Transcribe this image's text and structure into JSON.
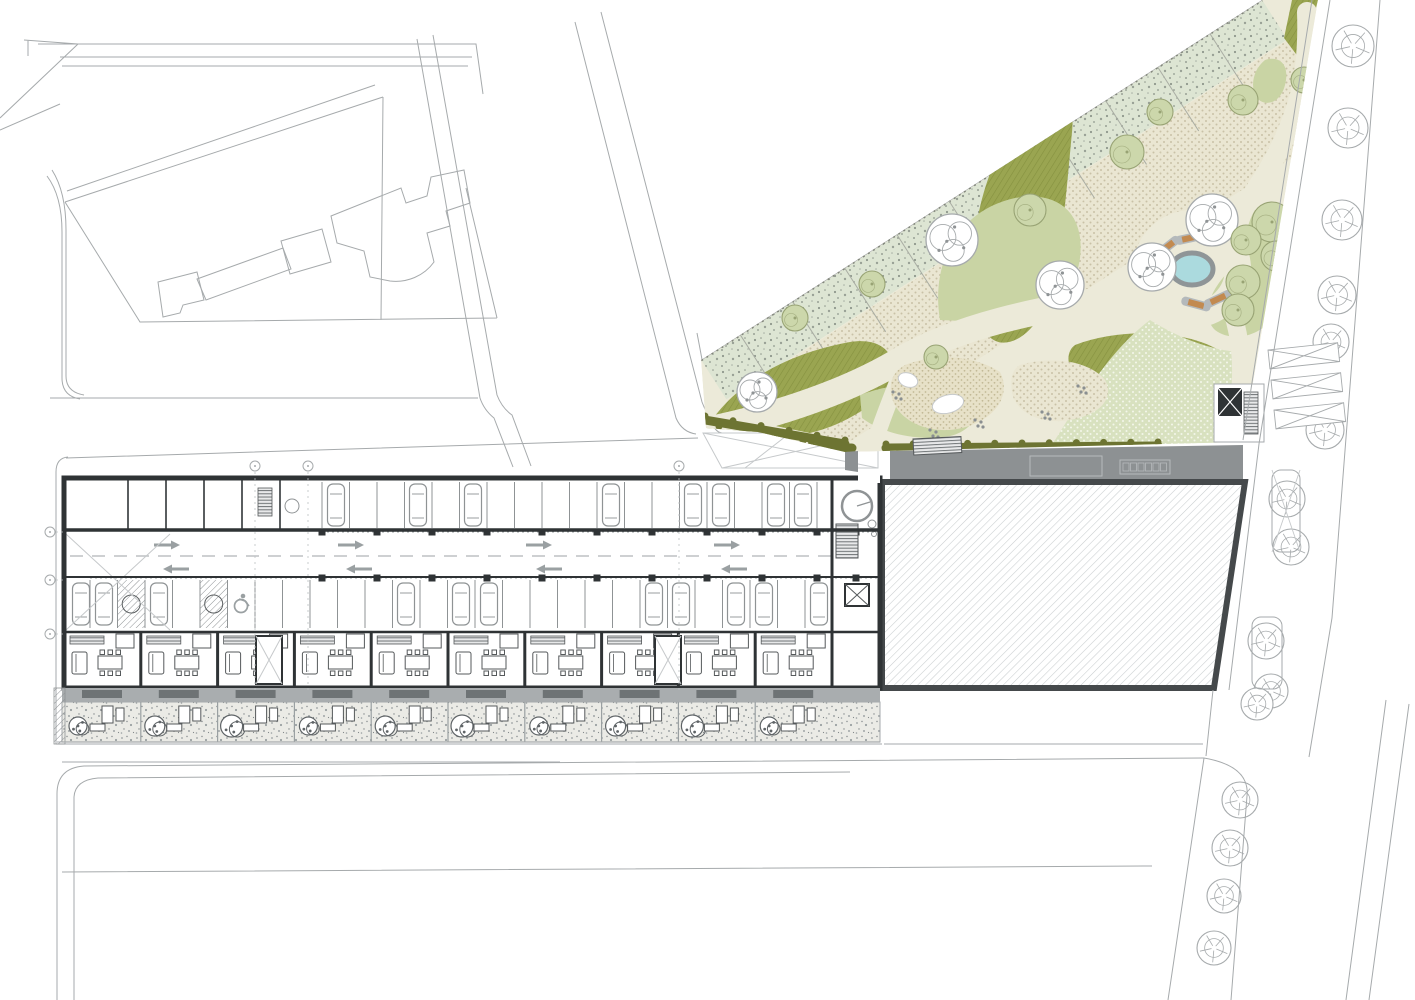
{
  "document": {
    "kind": "architectural-site-plan",
    "level": "ground-floor-plan"
  },
  "palette": {
    "line": "#a6aaac",
    "lineSoft": "#c6c9cb",
    "wall": "#2f3335",
    "wallMid": "#5a5e60",
    "roofGray": "#8d9193",
    "terraceGray": "#a9adaf",
    "matGray": "#6e7375",
    "cream": "#ecead9",
    "creamDot": "#c9c2a6",
    "sage": "#dde5d3",
    "olive": "#9aa551",
    "oliveLine": "#85913f",
    "greenLight": "#c9d4a4",
    "greenDotted": "#d8e1bf",
    "sand": "#e7e1c8",
    "pond": "#abdade",
    "pondRim": "#8f9597",
    "hedge": "#6d7432",
    "orange": "#c28a50",
    "treeGreen": "#ccd7ab",
    "treeGreenEdge": "#98a374",
    "gravel": "#ebebe6",
    "arrow": "#9aa0a2",
    "hatch": "#c9cdcf"
  },
  "park": {
    "pond": {
      "cx": 1192,
      "cy": 269,
      "rx": 21,
      "ry": 16,
      "apron": 46
    },
    "benches": [
      [
        1167,
        247,
        -38
      ],
      [
        1190,
        238,
        -12
      ],
      [
        1196,
        304,
        15
      ],
      [
        1218,
        299,
        -25
      ]
    ],
    "trees_white": [
      [
        1212,
        220,
        26
      ],
      [
        1152,
        267,
        24
      ],
      [
        1060,
        285,
        24
      ],
      [
        952,
        240,
        26
      ],
      [
        816,
        250,
        24
      ],
      [
        757,
        392,
        20
      ]
    ],
    "trees_green": [
      [
        1272,
        222,
        20
      ],
      [
        1276,
        256,
        15
      ],
      [
        1246,
        240,
        15
      ],
      [
        1243,
        282,
        17
      ],
      [
        1238,
        310,
        16
      ],
      [
        1127,
        152,
        17
      ],
      [
        1160,
        112,
        13
      ],
      [
        1243,
        100,
        15
      ],
      [
        1304,
        80,
        13
      ],
      [
        1030,
        210,
        16
      ],
      [
        872,
        284,
        13
      ],
      [
        936,
        357,
        12
      ],
      [
        795,
        318,
        13
      ]
    ],
    "hedge_runs": [
      [
        705,
        420,
        845,
        444
      ],
      [
        757,
        448,
        852,
        448
      ],
      [
        886,
        448,
        1158,
        446
      ]
    ],
    "pebble_clusters": [
      [
        975,
        420
      ],
      [
        1042,
        412
      ],
      [
        893,
        392
      ],
      [
        1078,
        386
      ],
      [
        930,
        430
      ]
    ],
    "play_shapes": [
      [
        948,
        404,
        16,
        9,
        -15
      ],
      [
        908,
        380,
        10,
        7,
        20
      ]
    ]
  },
  "service_roof": {
    "skylights": [
      [
        1030,
        456,
        72,
        20
      ],
      [
        1120,
        460,
        50,
        14
      ]
    ],
    "grille": [
      913,
      439,
      48,
      16
    ],
    "elevator": [
      1218,
      388,
      24,
      28
    ],
    "stairs": [
      1244,
      392,
      14,
      42
    ]
  },
  "east_street": {
    "trees": [
      [
        1353,
        46,
        21
      ],
      [
        1348,
        128,
        20
      ],
      [
        1342,
        220,
        20
      ],
      [
        1337,
        295,
        19
      ],
      [
        1331,
        342,
        18
      ],
      [
        1325,
        430,
        19
      ],
      [
        1287,
        499,
        18
      ],
      [
        1291,
        547,
        18
      ],
      [
        1266,
        641,
        18
      ],
      [
        1271,
        691,
        17
      ],
      [
        1257,
        704,
        16
      ],
      [
        1240,
        800,
        18
      ],
      [
        1230,
        848,
        18
      ],
      [
        1224,
        896,
        17
      ],
      [
        1214,
        948,
        17
      ]
    ],
    "crossings": [
      [
        1268,
        350
      ],
      [
        1271,
        380
      ],
      [
        1274,
        410
      ]
    ],
    "islands": [
      [
        1272,
        470,
        28,
        82,
        true
      ],
      [
        1252,
        617,
        30,
        72,
        false
      ]
    ]
  },
  "building": {
    "cars_top_x": [
      336,
      418,
      473,
      611,
      693,
      721,
      776,
      803
    ],
    "cars_bottom_x": [
      81,
      104,
      159,
      406,
      461,
      489,
      654,
      681,
      736,
      764,
      819
    ],
    "arrows_west": [
      [
        168,
        545
      ],
      [
        352,
        545
      ],
      [
        540,
        545
      ],
      [
        728,
        545
      ]
    ],
    "arrows_east": [
      [
        175,
        569
      ],
      [
        358,
        569
      ],
      [
        548,
        569
      ],
      [
        733,
        569
      ]
    ],
    "columns_x": [
      322,
      377,
      432,
      487,
      542,
      597,
      652,
      707,
      762,
      817,
      856
    ],
    "room_walls_x": [
      128,
      166,
      204,
      242,
      280
    ],
    "hatched_stalls": [
      [
        117.5,
        580
      ],
      [
        200,
        580
      ]
    ],
    "accessible_stall": [
      241,
      603
    ],
    "grid_bubbles_top_x": [
      255,
      308,
      679
    ],
    "grid_bubbles_left_y": [
      532,
      580,
      634
    ],
    "units": {
      "x0": 64,
      "w": 76.8,
      "count": 10
    },
    "cores": [
      [
        256,
        636
      ],
      [
        655,
        636
      ]
    ],
    "lobby": {
      "circle": [
        857,
        506,
        15
      ],
      "stairs": [
        836,
        524,
        22,
        34
      ],
      "elevator": [
        845,
        584,
        24,
        22
      ]
    }
  },
  "icons": {
    "deciduous_tree": "tree-deciduous-icon",
    "street_tree": "tree-street-icon",
    "shrub": "shrub-icon",
    "car": "car-icon",
    "direction_arrow": "direction-arrow-icon",
    "accessible_parking": "accessible-parking-icon",
    "elevator": "elevator-icon",
    "stairs": "stairs-icon",
    "bench": "bench-icon",
    "pond": "pond-icon",
    "grid_bubble": "grid-bubble"
  }
}
